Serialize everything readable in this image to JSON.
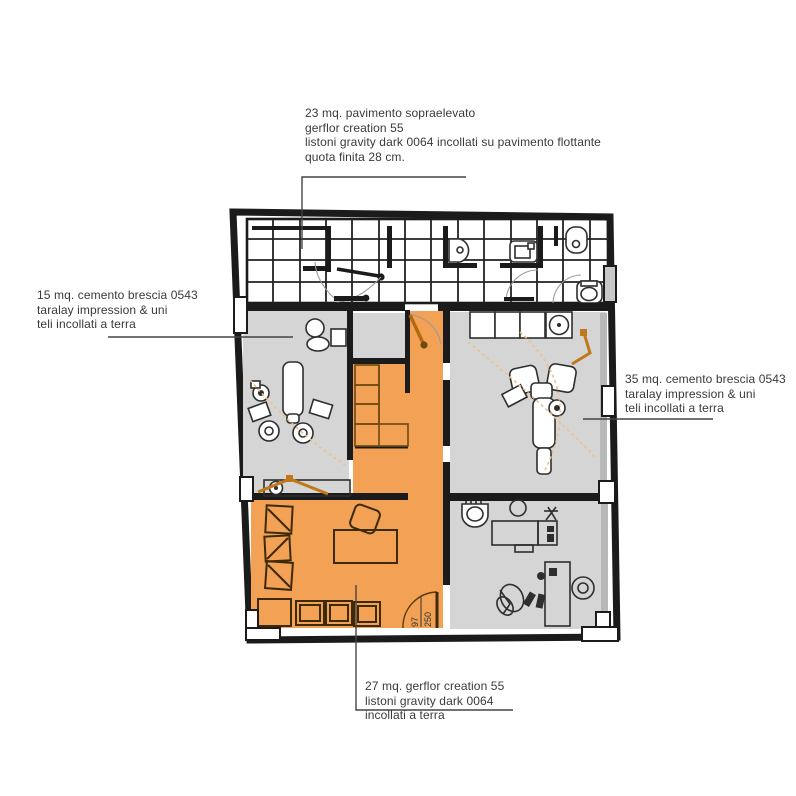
{
  "annotations": {
    "raised_floor": {
      "lines": [
        "23 mq. pavimento sopraelevato",
        "gerflor creation 55",
        "listoni gravity dark 0064 incollati su pavimento flottante",
        "quota finita 28 cm."
      ]
    },
    "room_left": {
      "lines": [
        "15 mq. cemento brescia 0543",
        "taralay impression & uni",
        "teli incollati a terra"
      ]
    },
    "room_right": {
      "lines": [
        "35 mq. cemento brescia 0543",
        "taralay impression & uni",
        "teli incollati a terra"
      ]
    },
    "room_bottom": {
      "lines": [
        "27 mq. gerflor creation 55",
        "listoni gravity dark 0064",
        "incollati a terra"
      ]
    }
  },
  "plan": {
    "door_label": {
      "width": "97",
      "height": "250"
    }
  },
  "colors": {
    "orange_floor": "#F2A155",
    "gray_floor": "#D5D5D5",
    "wall": "#1B1B1B",
    "furniture_orange": "#C07818",
    "text_ink": "#3A3A3A"
  }
}
